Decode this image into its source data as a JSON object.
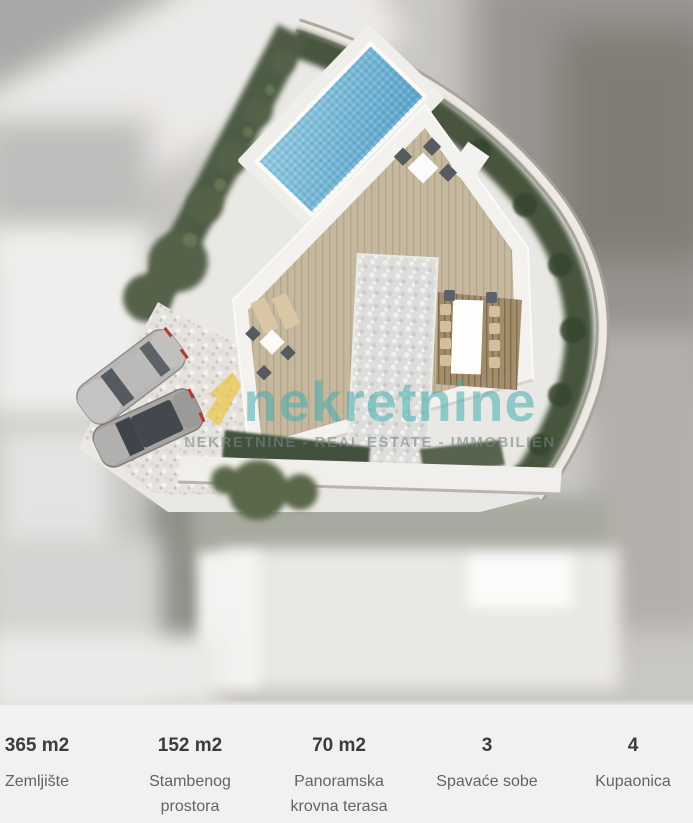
{
  "image": {
    "watermark": {
      "brand": "nekretnine",
      "subtitle": "NEKRETNINE - REAL ESTATE - IMMOBILIEN"
    },
    "colors": {
      "brand_teal": "#42adb1",
      "logo_yellow": "#e9c43e",
      "pool_blue": "#6fb4d4",
      "deck_tan": "#c6b89f",
      "vegetation_green": "#4e5c44",
      "stats_background": "#f2f1f0",
      "stat_value_color": "#3c3c3e",
      "stat_label_color": "#636366"
    }
  },
  "stats": {
    "items": [
      {
        "value": "365 m2",
        "label": "Zemljište"
      },
      {
        "value": "152 m2",
        "label": "Stambenog prostora"
      },
      {
        "value": "70 m2",
        "label": "Panoramska krovna terasa"
      },
      {
        "value": "3",
        "label": "Spavaće sobe"
      },
      {
        "value": "4",
        "label": "Kupaonica"
      }
    ]
  }
}
